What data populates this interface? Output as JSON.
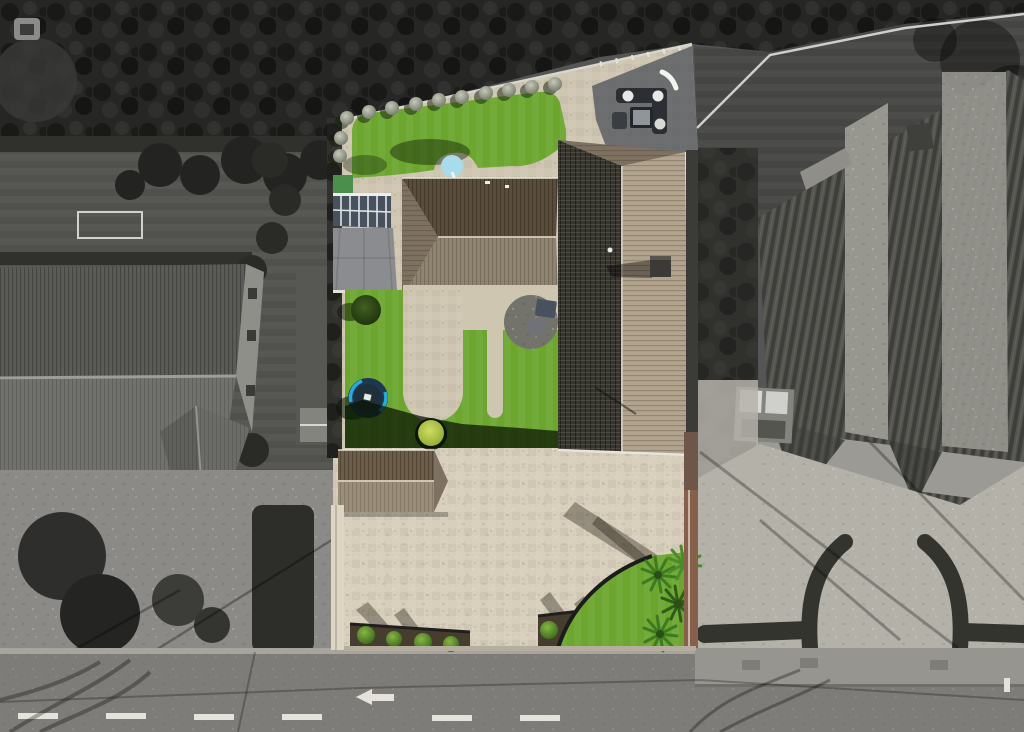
{
  "palette": {
    "trees": "#262624",
    "left_lawn_gray": "#50504d",
    "left_house_north": "#5b5b58",
    "left_house_south": "#71716d",
    "left_house_wall": "#8f8f8a",
    "left_patio": "#8b8a86",
    "hedge_dark": "#30302d",
    "neighbor_lawn_dark": "#454543",
    "right_house_dark": "#54544f",
    "right_house_light": "#97968f",
    "gravel": "#b4b1a9",
    "road": "#7d7c78",
    "sidewalk": "#97958f",
    "curb": "#a6a49d",
    "white_paint": "#e4e2da",
    "lawn": "#6ca62f",
    "lawn_dark": "#1e2f0d",
    "paving": "#cfc6b2",
    "driveway": "#d7cebb",
    "patio_shadow": "#4b5058",
    "roof_tan": "#b1a38e",
    "roof_charcoal": "#37352e",
    "roof_brown_dark": "#5b4d3b",
    "roof_brown_mid": "#908470",
    "roof_hip": "#7e7161",
    "garage_north": "#6e5d49",
    "garage_south": "#9d8e7a",
    "conservatory_glass": "#47525e",
    "conservatory_frame": "#dfe3e6",
    "gray_roof": "#8a8c8f",
    "trampoline_blue": "#2aaad6",
    "trampoline_dark": "#1d3850",
    "brick_wall": "#86604a",
    "cream_wall": "#ded6c3",
    "soil": "#473d2f",
    "bush": "#5e9130",
    "lime_bush": "#a8c245",
    "palm": "#3e7a22",
    "furniture_dark": "#2b2f33",
    "disc_blue": "#a8dcec",
    "shed_gray": "#84847f"
  },
  "elements": [
    "tree-canopy",
    "left-neighbour-garden",
    "left-neighbour-house",
    "left-neighbour-patio",
    "subject-property",
    "top-lawn",
    "ball-shrub-border",
    "garden-furniture-set",
    "conservatory",
    "gray-flat-roof",
    "main-house-east-west-wing",
    "main-house-north-south-wing",
    "chimney",
    "back-lawn",
    "trampoline",
    "round-bush",
    "lime-bush",
    "circular-patio",
    "hot-tub",
    "garage-outbuilding",
    "block-paved-driveway",
    "planting-beds",
    "front-lawn-triangle",
    "palm-plants",
    "brick-boundary-wall",
    "cream-boundary-wall",
    "right-neighbour-lawn",
    "boundary-fence",
    "right-neighbour-house",
    "garden-shed",
    "gravel-driveway",
    "curved-hedge-walls",
    "road",
    "road-centre-line",
    "road-arrow-marking",
    "sidewalk"
  ]
}
